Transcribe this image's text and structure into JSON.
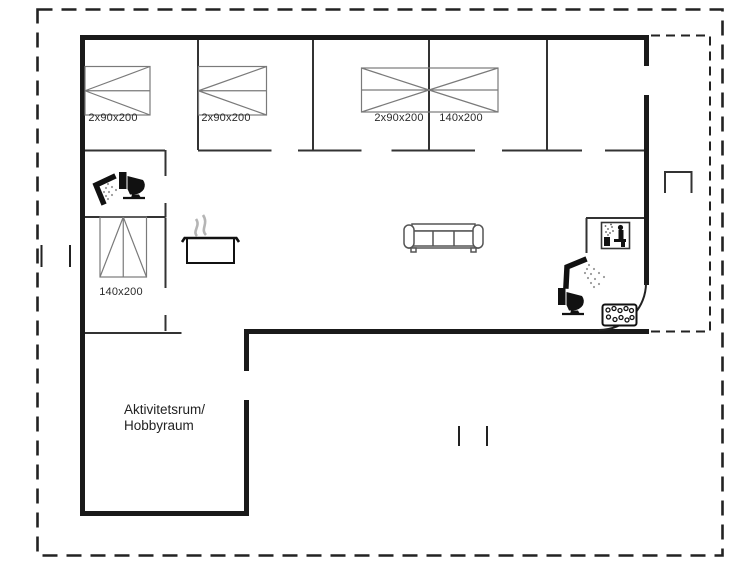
{
  "floorplan": {
    "bed_labels": [
      "2x90x200",
      "2x90x200",
      "2x90x200",
      "140x200",
      "140x200"
    ],
    "room_labels": {
      "activity_line1": "Aktivitetsrum/",
      "activity_line2": "Hobbyraum"
    },
    "colors": {
      "background": "#ffffff",
      "walls": "#1a1a1a",
      "furniture": "#7a7a7a",
      "steam": "#b5b5b5",
      "text": "#2b2b2b"
    },
    "icons": [
      "shower-icon",
      "toilet-icon",
      "cooking-pot-icon",
      "steam-icon",
      "sofa-icon",
      "sauna-icon",
      "whirlpool-tub-icon",
      "door-swing-arc",
      "terrace-bench-icon",
      "boundary-tick"
    ]
  }
}
